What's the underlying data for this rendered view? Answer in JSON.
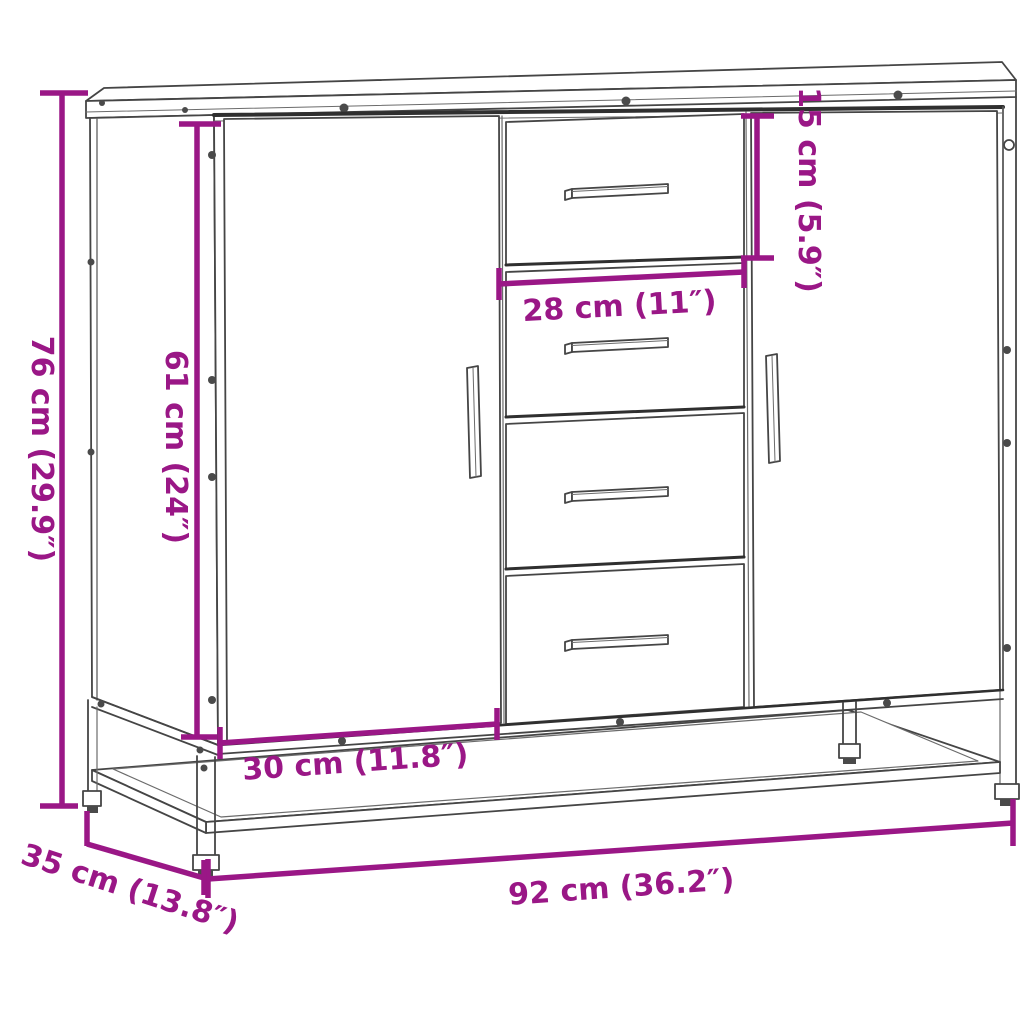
{
  "figure": {
    "kind": "product-dimension-diagram",
    "subject": "sideboard with two doors, four drawers and metal base frame"
  },
  "colors": {
    "dimension": "#9A1786",
    "outline": "#454545",
    "shadow_line": "#2f2f2f",
    "background": "#ffffff"
  },
  "dimensions": {
    "overall_height": {
      "label": "76 cm (29.9″)",
      "cm": 76,
      "inch": 29.9
    },
    "door_height": {
      "label": "61 cm (24″)",
      "cm": 61,
      "inch": 24
    },
    "top_drawer_height": {
      "label": "15 cm (5.9″)",
      "cm": 15,
      "inch": 5.9
    },
    "drawer_width": {
      "label": "28 cm (11″)",
      "cm": 28,
      "inch": 11
    },
    "door_width": {
      "label": "30 cm (11.8″)",
      "cm": 30,
      "inch": 11.8
    },
    "overall_width": {
      "label": "92 cm (36.2″)",
      "cm": 92,
      "inch": 36.2
    },
    "overall_depth": {
      "label": "35 cm (13.8″)",
      "cm": 35,
      "inch": 13.8
    }
  }
}
